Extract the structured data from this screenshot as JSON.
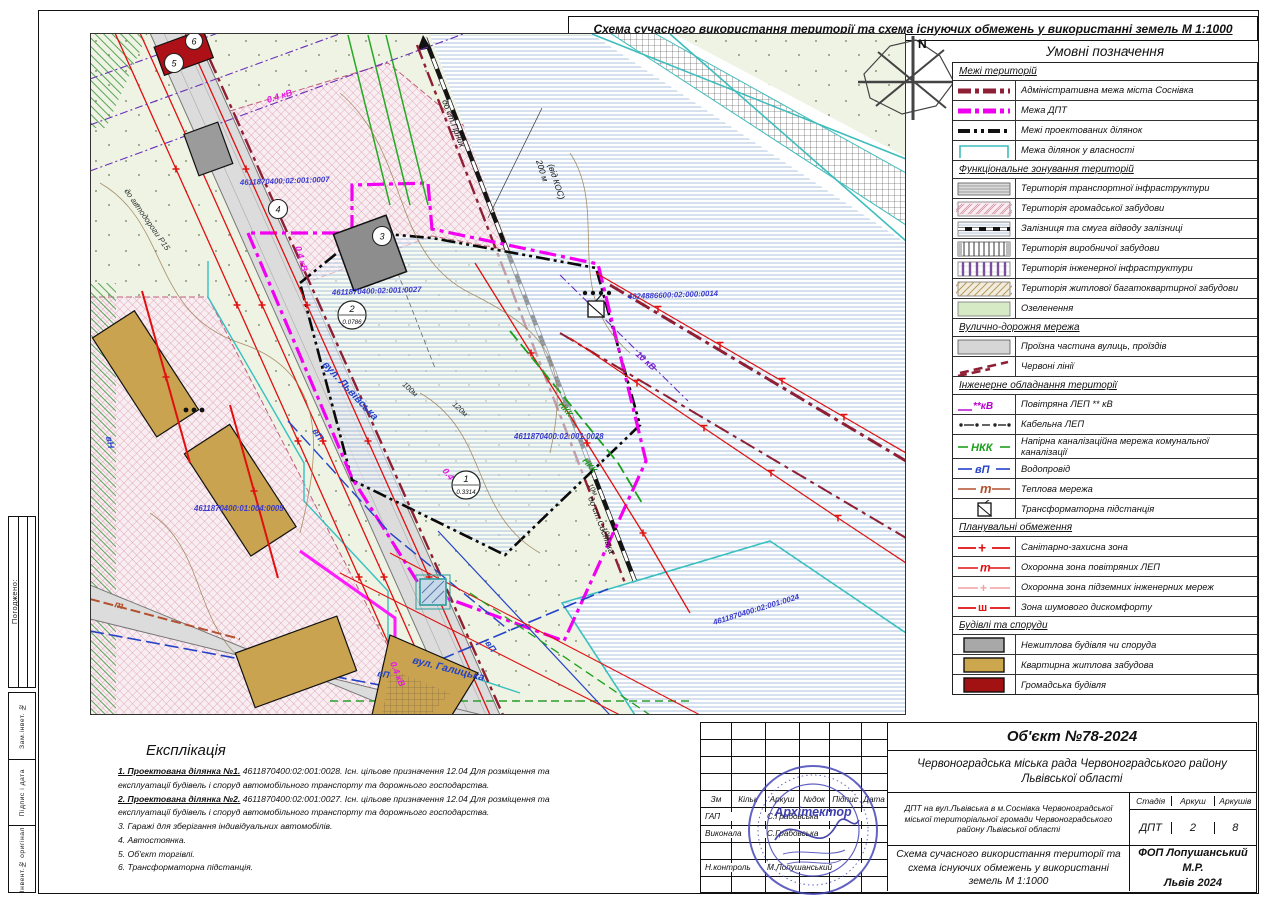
{
  "title": "Схема сучасного використання території та схема існуючих обмежень у використанні земель  М 1:1000",
  "frame": {
    "approved": "Погоджено:",
    "strips": [
      "Зам.інвет. №",
      "Підпис і дата",
      "Інвент.№ оригінал"
    ]
  },
  "colors": {
    "magenta": "#ee00ee",
    "maroon": "#8e1f35",
    "cyan": "#3fbdbd",
    "red": "#e01010",
    "green": "#1ca01c",
    "blue": "#2442c8",
    "purple": "#7a1fd0",
    "tan": "#c9a34f",
    "public_building": "#ad1016",
    "nonresidential": "#9b9b9b"
  },
  "map": {
    "labels": {
      "lvivska": "вул. Львівська",
      "halytska": "вул. Галицька",
      "r15": "до автодороги Р15",
      "st_top": "до ст.Гірник",
      "st_bottom": "до ст.Соснівка",
      "dist200": "200 м",
      "dist200b": "(від КОС)",
      "m100": "100м",
      "m120": "120м",
      "m10a": "10м",
      "m10b": "10м",
      "kv04a": "0.4 кВ",
      "kv04b": "0.4 кВ",
      "kv04c": "0.4 кВ",
      "kv04d": "0.4 кВ",
      "kv10": "10 кВ",
      "nkk1": "НКК",
      "nkk2": "НКК",
      "vp1": "вП",
      "vp2": "вП",
      "vp3": "вП",
      "vn": "вН",
      "heat": "т",
      "p0007": "4611870400:02:001:0007",
      "p0027": "4611870400:02:001:0027",
      "p0028": "4611870400:02:001:0028",
      "p0005": "4611870400:01:004:0005",
      "p0014": "4824886600:02:000:0014",
      "p0024": "4611870400:02:001:0024",
      "north": "N",
      "c1": "1",
      "a1": "0.3314",
      "c2": "2",
      "a2": "0.0786",
      "c3": "3",
      "c4": "4",
      "c5": "5",
      "c6": "6"
    }
  },
  "legend": {
    "title": "Умовні позначення",
    "sym_texts": {
      "lep_air": "**кВ",
      "nkk": "НКК",
      "vp": "вП",
      "heat": "т",
      "plus": "+",
      "t": "т",
      "sh": "ш"
    },
    "sections": [
      {
        "header": "Межі територій",
        "items": [
          {
            "sym": "admin",
            "label": "Адміністративна межа міста Соснівка"
          },
          {
            "sym": "dpt",
            "label": "Межа ДПТ"
          },
          {
            "sym": "project",
            "label": "Межі проектованих ділянок"
          },
          {
            "sym": "own",
            "label": "Межа ділянок у власності"
          }
        ]
      },
      {
        "header": "Функціональне зонування територій",
        "items": [
          {
            "sym": "transport",
            "label": "Територія транспортної інфраструктури"
          },
          {
            "sym": "public",
            "label": "Територія громадської забудови"
          },
          {
            "sym": "rail",
            "label": "Залізниця та смуга відводу залізниці"
          },
          {
            "sym": "industrial",
            "label": "Територія виробничої забудови"
          },
          {
            "sym": "engineering",
            "label": "Територія інженерної інфраструктури"
          },
          {
            "sym": "residential",
            "label": "Територія житлової багатоквартирної забудови"
          },
          {
            "sym": "greenery",
            "label": "Озеленення"
          }
        ]
      },
      {
        "header": "Вулично-дорожня мережа",
        "items": [
          {
            "sym": "roadway",
            "label": "Проїзна частина вулиць, проїздів"
          },
          {
            "sym": "redlines",
            "label": "Червоні лінії"
          }
        ]
      },
      {
        "header": "Інженерне обладнання території",
        "items": [
          {
            "sym": "lep-air",
            "label": "Повітряна ЛЕП ** кВ"
          },
          {
            "sym": "lep-cable",
            "label": "Кабельна ЛЕП"
          },
          {
            "sym": "nkk",
            "label": "Напірна каналізаційна мережа комунальної каналізації"
          },
          {
            "sym": "vp",
            "label": "Водопровід"
          },
          {
            "sym": "heat",
            "label": "Теплова мережа"
          },
          {
            "sym": "tp",
            "label": "Трансформаторна підстанція"
          }
        ]
      },
      {
        "header": "Планувальні обмеження",
        "items": [
          {
            "sym": "sanzone",
            "label": "Санітарно-захисна зона"
          },
          {
            "sym": "lepzone",
            "label": "Охоронна зона повітряних ЛЕП"
          },
          {
            "sym": "underzone",
            "label": "Охоронна зона підземних інженерних мереж"
          },
          {
            "sym": "noise",
            "label": "Зона шумового дискомфорту"
          }
        ]
      },
      {
        "header": "Будівлі та споруди",
        "items": [
          {
            "sym": "bld-gray",
            "label": "Нежитлова будівля чи споруда"
          },
          {
            "sym": "bld-tan",
            "label": "Квартирна житлова забудова"
          },
          {
            "sym": "bld-red",
            "label": "Громадська будівля"
          }
        ]
      }
    ]
  },
  "explication": {
    "title": "Експлікація",
    "items": [
      {
        "lead": "1. Проектована ділянка №1.",
        "rest": " 4611870400:02:001:0028. Існ. цільове призначення 12.04 Для розміщення та експлуатації будівель і споруд автомобільного транспорту та дорожнього господарства."
      },
      {
        "lead": "2. Проектована ділянка №2.",
        "rest": " 4611870400:02:001:0027. Існ. цільове призначення 12.04 Для розміщення та експлуатації будівель і споруд автомобільного транспорту та дорожнього господарства."
      },
      {
        "lead": "",
        "rest": "3. Гаражі для зберігання індивідуальних автомобілів."
      },
      {
        "lead": "",
        "rest": "4. Автостоянка."
      },
      {
        "lead": "",
        "rest": "5. Об'єкт торгівлі."
      },
      {
        "lead": "",
        "rest": "6. Трансформаторна підстанція."
      }
    ]
  },
  "titleblock": {
    "object": "Об'єкт №78-2024",
    "org": "Червоноградська міська рада Червоноградського району Львівської області",
    "project": "ДПТ на вул.Львівська в м.Соснівка Червоноградської міської територіальної громади Червоноградського району Львівської області",
    "sheet_name": "Схема сучасного використання території та схема існуючих обмежень у використанні земель  М 1:1000",
    "firm1": "ФОП Лопушанський М.Р.",
    "firm2": "Львів 2024",
    "stage_label": "Стадія",
    "sheet_label": "Аркуш",
    "sheets_label": "Аркушів",
    "stage": "ДПТ",
    "sheet_no": "2",
    "sheets_total": "8",
    "cols": [
      "Зм",
      "Кільк",
      "Аркуш",
      "№док",
      "Підпис",
      "Дата"
    ],
    "roles": [
      {
        "role": "ГАП",
        "name": "С.Грабовська"
      },
      {
        "role": "Виконала",
        "name": "С.Грабовська"
      },
      {
        "role": "Н.контроль",
        "name": "М.Лопушанський"
      }
    ],
    "stamp": "Архітектор"
  }
}
